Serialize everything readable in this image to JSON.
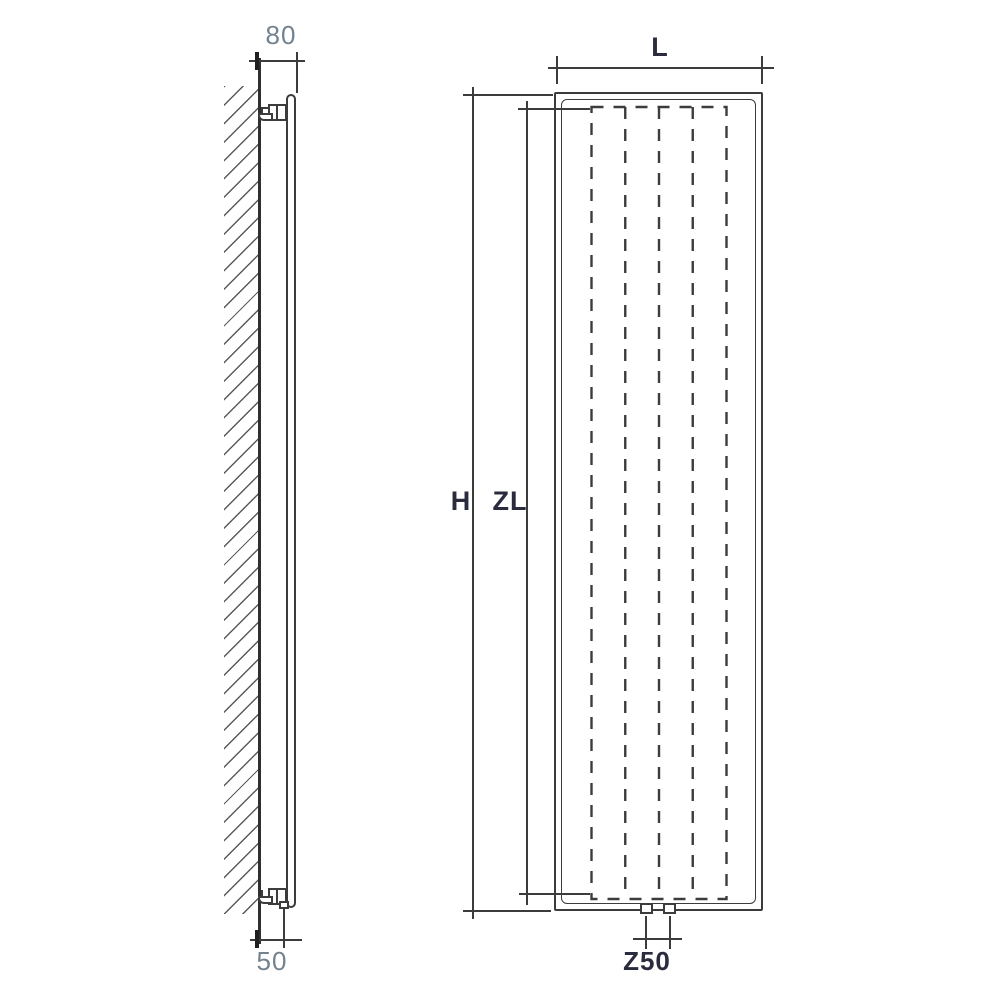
{
  "drawing": {
    "kind": "radiator installation dimension diagram",
    "side_view": {
      "wall_offset_top_label": "80",
      "wall_offset_bottom_label": "50"
    },
    "front_view": {
      "width_label": "L",
      "height_label": "H",
      "panel_length_label": "ZL",
      "connection_spacing_label": "Z50"
    },
    "colors": {
      "line": "#3c3c3c",
      "label_slate": "#72828f",
      "label_navy": "#2b2b3e"
    }
  }
}
